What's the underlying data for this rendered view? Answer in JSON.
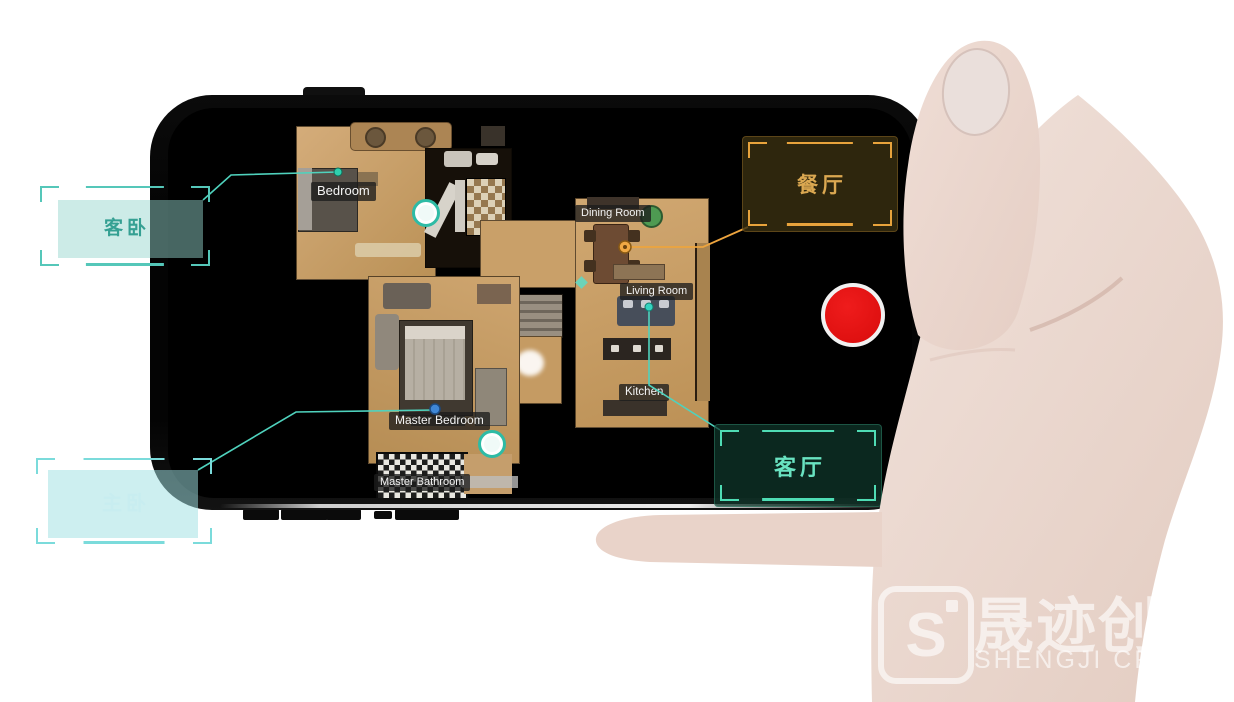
{
  "app": {
    "description": "room capture app on phone",
    "record_button_color": "#d90c0c"
  },
  "floorplan": {
    "room_labels": [
      {
        "id": "bedroom",
        "text": "Bedroom"
      },
      {
        "id": "dining-room",
        "text": "Dining Room"
      },
      {
        "id": "living-room",
        "text": "Living Room"
      },
      {
        "id": "kitchen",
        "text": "Kitchen"
      },
      {
        "id": "master-bedroom",
        "text": "Master Bedroom"
      },
      {
        "id": "master-bathroom",
        "text": "Master Bathroom"
      }
    ]
  },
  "callouts": [
    {
      "id": "guest-bedroom",
      "text": "客卧",
      "color": "#55c7b9",
      "placement": "outside-top-left"
    },
    {
      "id": "master-bedroom",
      "text": "主卧",
      "color": "#7bdbdb",
      "placement": "outside-bottom-left"
    },
    {
      "id": "dining-room",
      "text": "餐厅",
      "color": "#e8a33c",
      "placement": "on-screen-top-right"
    },
    {
      "id": "living-room",
      "text": "客厅",
      "color": "#4fdcb4",
      "placement": "on-screen-bottom-right"
    }
  ],
  "accents": {
    "teal_line": "#4fd2bd",
    "orange_line": "#eda43e",
    "blue_marker": "#3f87d6"
  },
  "watermark": {
    "logo_monogram": "S",
    "cjk": "晟迹创",
    "latin": "SHENGJI CREA"
  }
}
